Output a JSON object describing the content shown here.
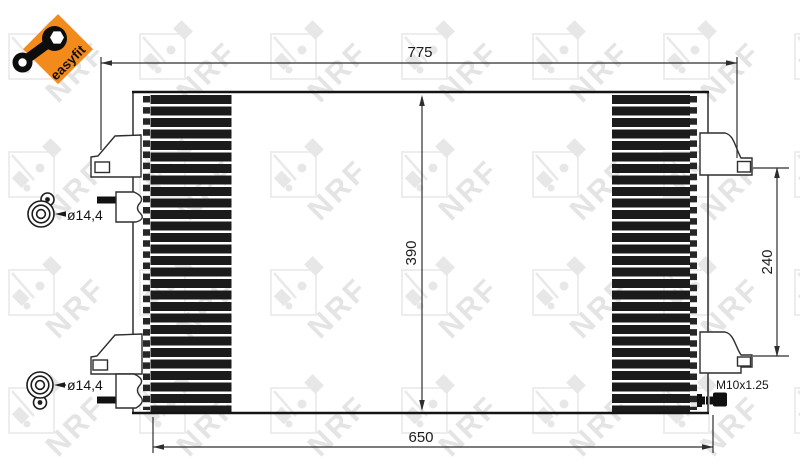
{
  "logo": {
    "tagline": "easyfit",
    "accent_color": "#F28A1C"
  },
  "watermark": {
    "text": "NRF"
  },
  "diagram": {
    "line_color": "#2e2e2e",
    "core_fill": "#1b1b1b",
    "dimensions": {
      "overall_width_mm": "775",
      "core_width_mm": "650",
      "core_height_mm": "390",
      "bracket_spacing_mm": "240",
      "upper_port_diameter": "ø14,4",
      "lower_port_diameter": "ø14,4",
      "sensor_thread": "M10x1.25"
    }
  }
}
